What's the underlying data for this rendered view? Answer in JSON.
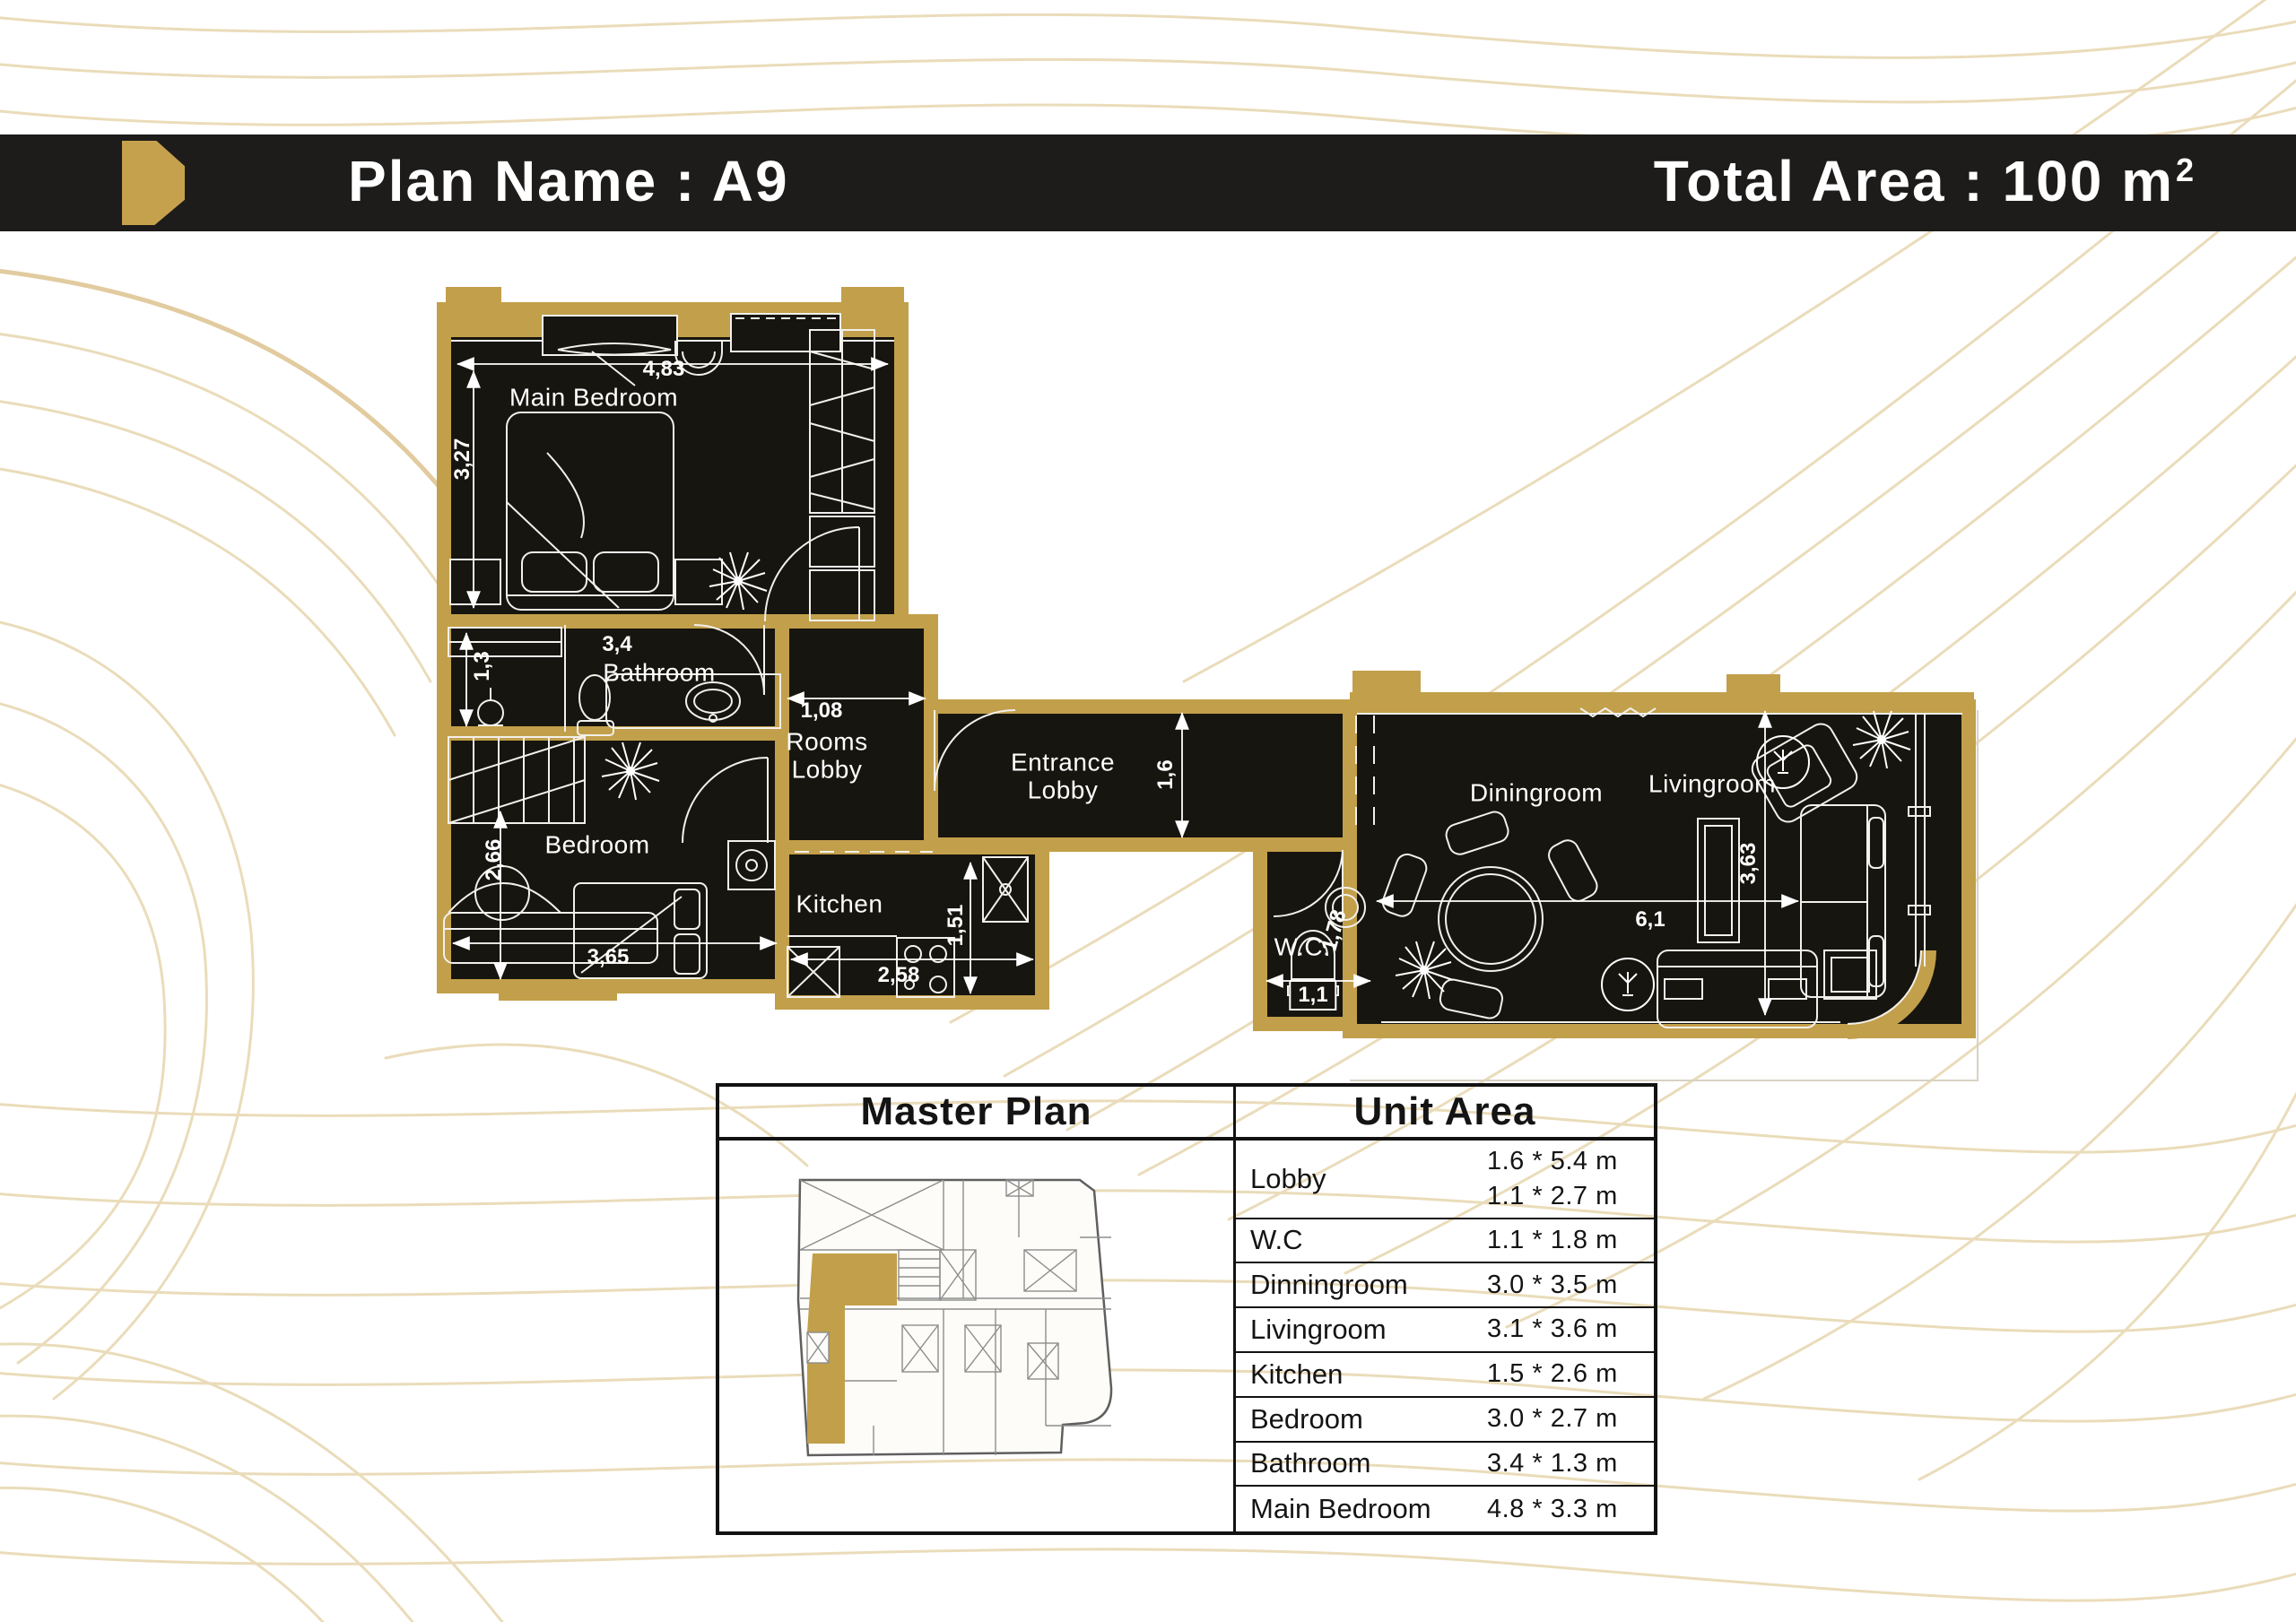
{
  "header": {
    "plan_name": "Plan Name : A9",
    "total_area": "Total Area : 100 m",
    "total_area_exponent": "2",
    "bar_color": "#1e1c1a",
    "accent_color": "#c29f4a"
  },
  "plan": {
    "wall_color": "#c29f4a",
    "room_fill": "#17150f",
    "line_color": "#ffffff",
    "labels": {
      "main_bedroom": "Main Bedroom",
      "bathroom": "Bathroom",
      "rooms_lobby": "Rooms Lobby",
      "bedroom": "Bedroom",
      "kitchen": "Kitchen",
      "entrance_lobby": "Entrance Lobby",
      "wc": "W.C.",
      "diningroom": "Diningroom",
      "livingroom": "Livingroom"
    },
    "dimensions": {
      "main_bedroom_w": "4,83",
      "main_bedroom_h": "3,27",
      "bathroom_w": "3,4",
      "closet_w": "1,3",
      "rooms_lobby_w": "1,08",
      "bedroom_h": "2,66",
      "bedroom_w": "3,65",
      "kitchen_h": "1,51",
      "kitchen_w": "2,58",
      "entrance_h": "1,6",
      "wc_h": "1,78",
      "wc_w": "1,1",
      "living_w": "6,1",
      "living_h": "3,63"
    }
  },
  "table": {
    "master_plan_header": "Master Plan",
    "unit_area_header": "Unit Area",
    "rows": [
      {
        "name": "Lobby",
        "dims": [
          "1.6  * 5.4 m",
          "1.1  * 2.7 m"
        ]
      },
      {
        "name": "W.C",
        "dims": [
          "1.1  * 1.8 m"
        ]
      },
      {
        "name": "Dinningroom",
        "dims": [
          "3.0  * 3.5 m"
        ]
      },
      {
        "name": "Livingroom",
        "dims": [
          "3.1  * 3.6 m"
        ]
      },
      {
        "name": "Kitchen",
        "dims": [
          "1.5 * 2.6 m"
        ]
      },
      {
        "name": "Bedroom",
        "dims": [
          "3.0 * 2.7 m"
        ]
      },
      {
        "name": "Bathroom",
        "dims": [
          "3.4  * 1.3 m"
        ]
      },
      {
        "name": "Main Bedroom",
        "dims": [
          "4.8 * 3.3 m"
        ]
      }
    ]
  }
}
